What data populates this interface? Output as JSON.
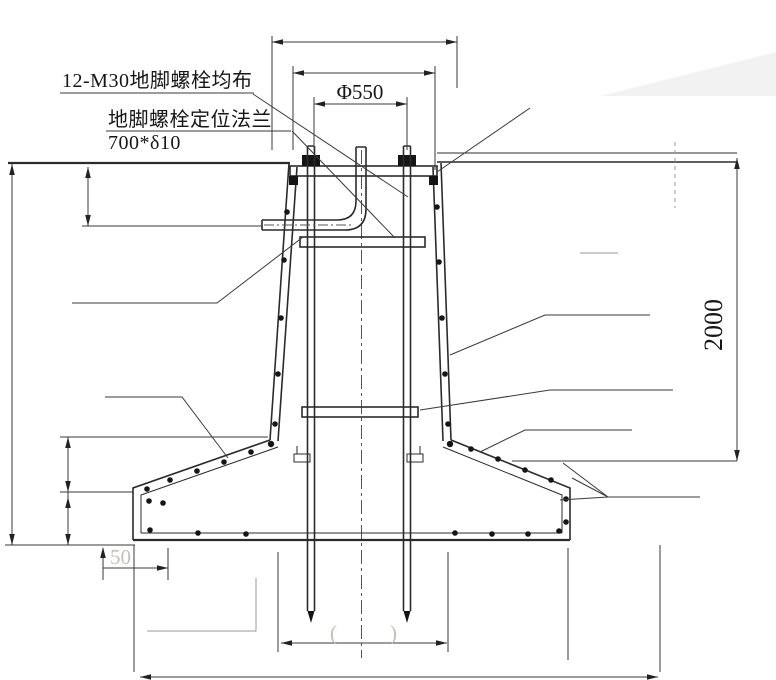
{
  "drawing": {
    "type": "foundation-anchor-bolt-section-detail",
    "labels": {
      "anchor_bolts": "12-M30地脚螺栓均布",
      "flange_line1": "地脚螺栓定位法兰",
      "flange_line2": "700*δ10"
    },
    "dimensions": {
      "bolt_circle": "Φ550",
      "embed_depth": "2000",
      "edge_offset": "50",
      "paren_open": "(",
      "paren_close": ")"
    },
    "colors": {
      "line": "#2b2b2b",
      "faint_text": "#c6beb9",
      "background": "#ffffff"
    }
  }
}
